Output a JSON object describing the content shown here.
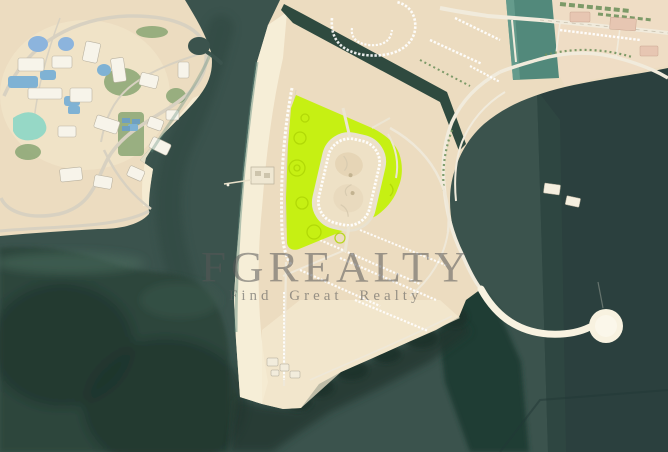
{
  "image": {
    "kind": "satellite-aerial-photo",
    "description": "Aerial satellite view of a coastal master-planned island development with a land plot highlighted in bright green, a circular lagoon, a lollipop-shaped pier and a resort peninsula",
    "width_px": 668,
    "height_px": 452
  },
  "watermark": {
    "brand": "FGREALTY",
    "tagline": "Find Great Realty",
    "brand_color": "rgba(88,88,88,0.55)",
    "tagline_color": "rgba(92,92,92,0.60)"
  },
  "colors": {
    "sea": "#3b534d",
    "sea_deep": "#2b403e",
    "seagrass_dark": "#22392f",
    "sand": "#ecdcc0",
    "beach": "#f7eed8",
    "road_light": "#f1ebdc",
    "canal_light": "#52897b",
    "canal_dark": "#2f4a3f",
    "highlight_plot": "#c6f013",
    "pool_blue": "#7fb2d4",
    "pool_turquoise": "#96d8c6",
    "greenery": "#7d9a67",
    "pier": "#f8f2e0"
  },
  "features": [
    "resort-peninsula",
    "sea-channel",
    "central-island",
    "highlighted-plot",
    "inner-oval-development",
    "circular-lagoon",
    "vertical-canal",
    "diagonal-canal",
    "villa-rows",
    "corniche-roads",
    "lollipop-pier",
    "seagrass-reef"
  ]
}
